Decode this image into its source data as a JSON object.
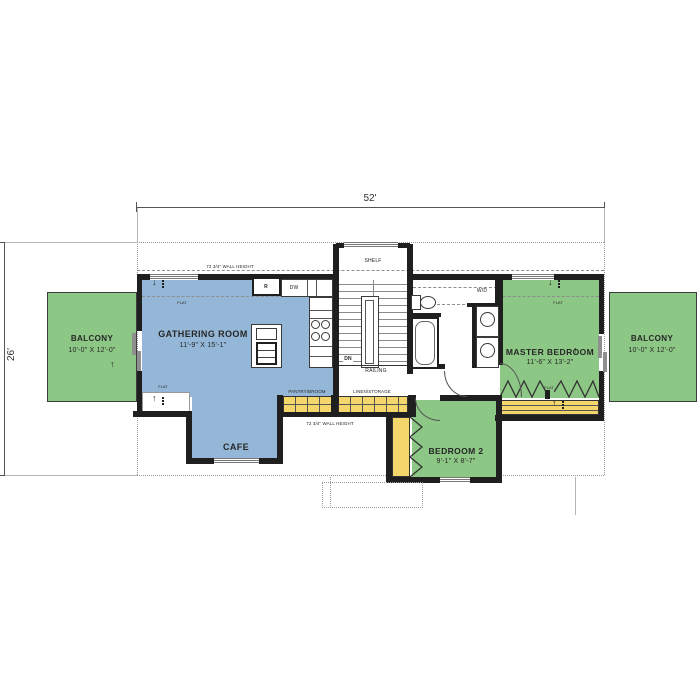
{
  "plan": {
    "overall_width": "52'",
    "overall_depth": "26'",
    "colors": {
      "wall": "#1f1f1f",
      "room_blue": "#94b7d8",
      "room_green": "#8dc785",
      "storage_yellow": "#f5d66a"
    },
    "rooms": {
      "gathering": {
        "name": "GATHERING ROOM",
        "size": "11'-9\" x 15'-1\""
      },
      "cafe": {
        "name": "CAFE"
      },
      "master": {
        "name": "MASTER BEDROOM",
        "size": "11'-6\" x 13'-2\""
      },
      "bedroom2": {
        "name": "BEDROOM 2",
        "size": "9'-1\" x 8'-7\""
      },
      "balcony_left": {
        "name": "BALCONY",
        "size": "10'-0\" x 12'-0\""
      },
      "balcony_right": {
        "name": "BALCONY",
        "size": "10'-0\" x 12'-0\""
      }
    },
    "storage": {
      "pantry": "PANTRY/BROOM",
      "linen": "LINEN/STORAGE"
    },
    "notes": {
      "wall_height": "72 3/4\" WALL HEIGHT",
      "flat": "FLAT",
      "shelf": "SHELF",
      "railing": "RAILING",
      "down": "DN",
      "washer_dryer": "W/D",
      "refrigerator": "R",
      "dishwasher": "DW"
    }
  }
}
